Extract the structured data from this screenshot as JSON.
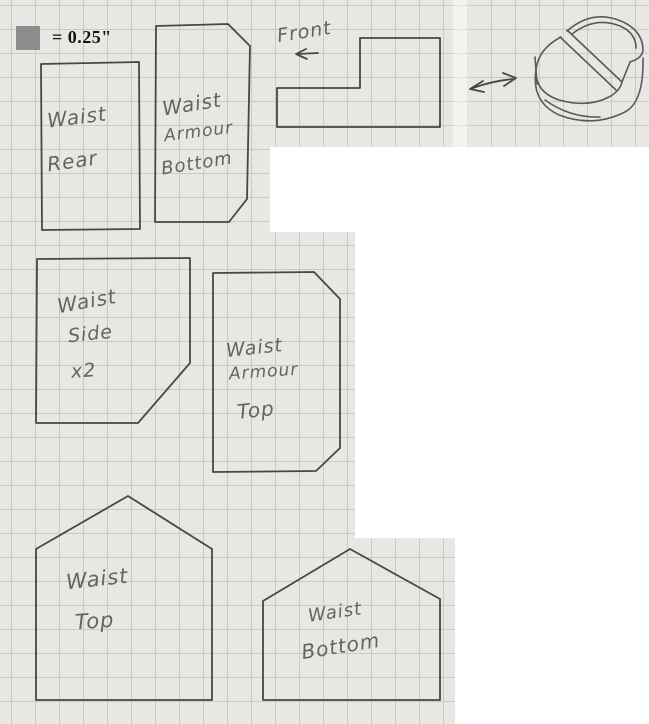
{
  "legend": {
    "scale_text": "= 0.25\"",
    "square_color": "#8c8c8c"
  },
  "annotations": {
    "front": "Front"
  },
  "pieces": {
    "waist_rear": {
      "line1": "Waist",
      "line2": "Rear"
    },
    "waist_armour_bottom": {
      "line1": "Waist",
      "line2": "Armour",
      "line3": "Bottom"
    },
    "waist_side": {
      "line1": "Waist",
      "line2": "Side",
      "line3": "x2"
    },
    "waist_armour_top": {
      "line1": "Waist",
      "line2": "Armour",
      "line3": "Top"
    },
    "waist_top": {
      "line1": "Waist",
      "line2": "Top"
    },
    "waist_bottom": {
      "line1": "Waist",
      "line2": "Bottom"
    }
  },
  "colors": {
    "paper": "#e9e7e4",
    "grid": "#c9c9c7",
    "pencil": "#474747",
    "handwriting": "#525252",
    "legend_text": "#141414",
    "cutout": "#ffffff"
  }
}
